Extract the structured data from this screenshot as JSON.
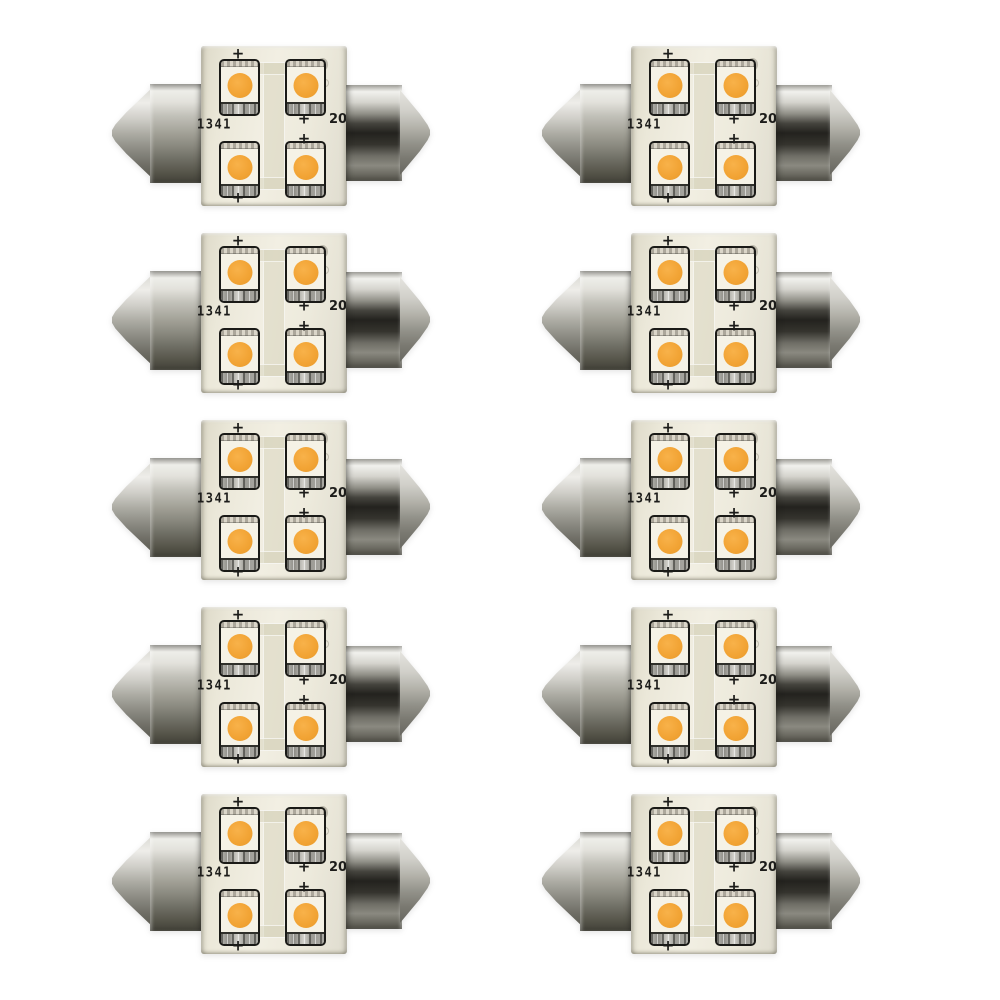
{
  "background": "#ffffff",
  "grid": {
    "columns": 2,
    "rows": 5,
    "count": 10
  },
  "bulb": {
    "date_code": "1341",
    "size_code": "20",
    "polarity_mark": "+",
    "led_count": 4,
    "colors": {
      "led_amber": "#F2A435",
      "led_amber_light": "#F8B24A",
      "led_body": "#F5F2E6",
      "package_outline": "#1A1A17",
      "pcb_base": "#EBE8D9",
      "pcb_trace": "#D6D1B9",
      "metal_highlight": "#F1F1ED",
      "metal_mid": "#A5A49A",
      "metal_dark": "#403F37",
      "electrode_gray": "#9D9C96",
      "text_black": "#1C1C1A"
    }
  }
}
